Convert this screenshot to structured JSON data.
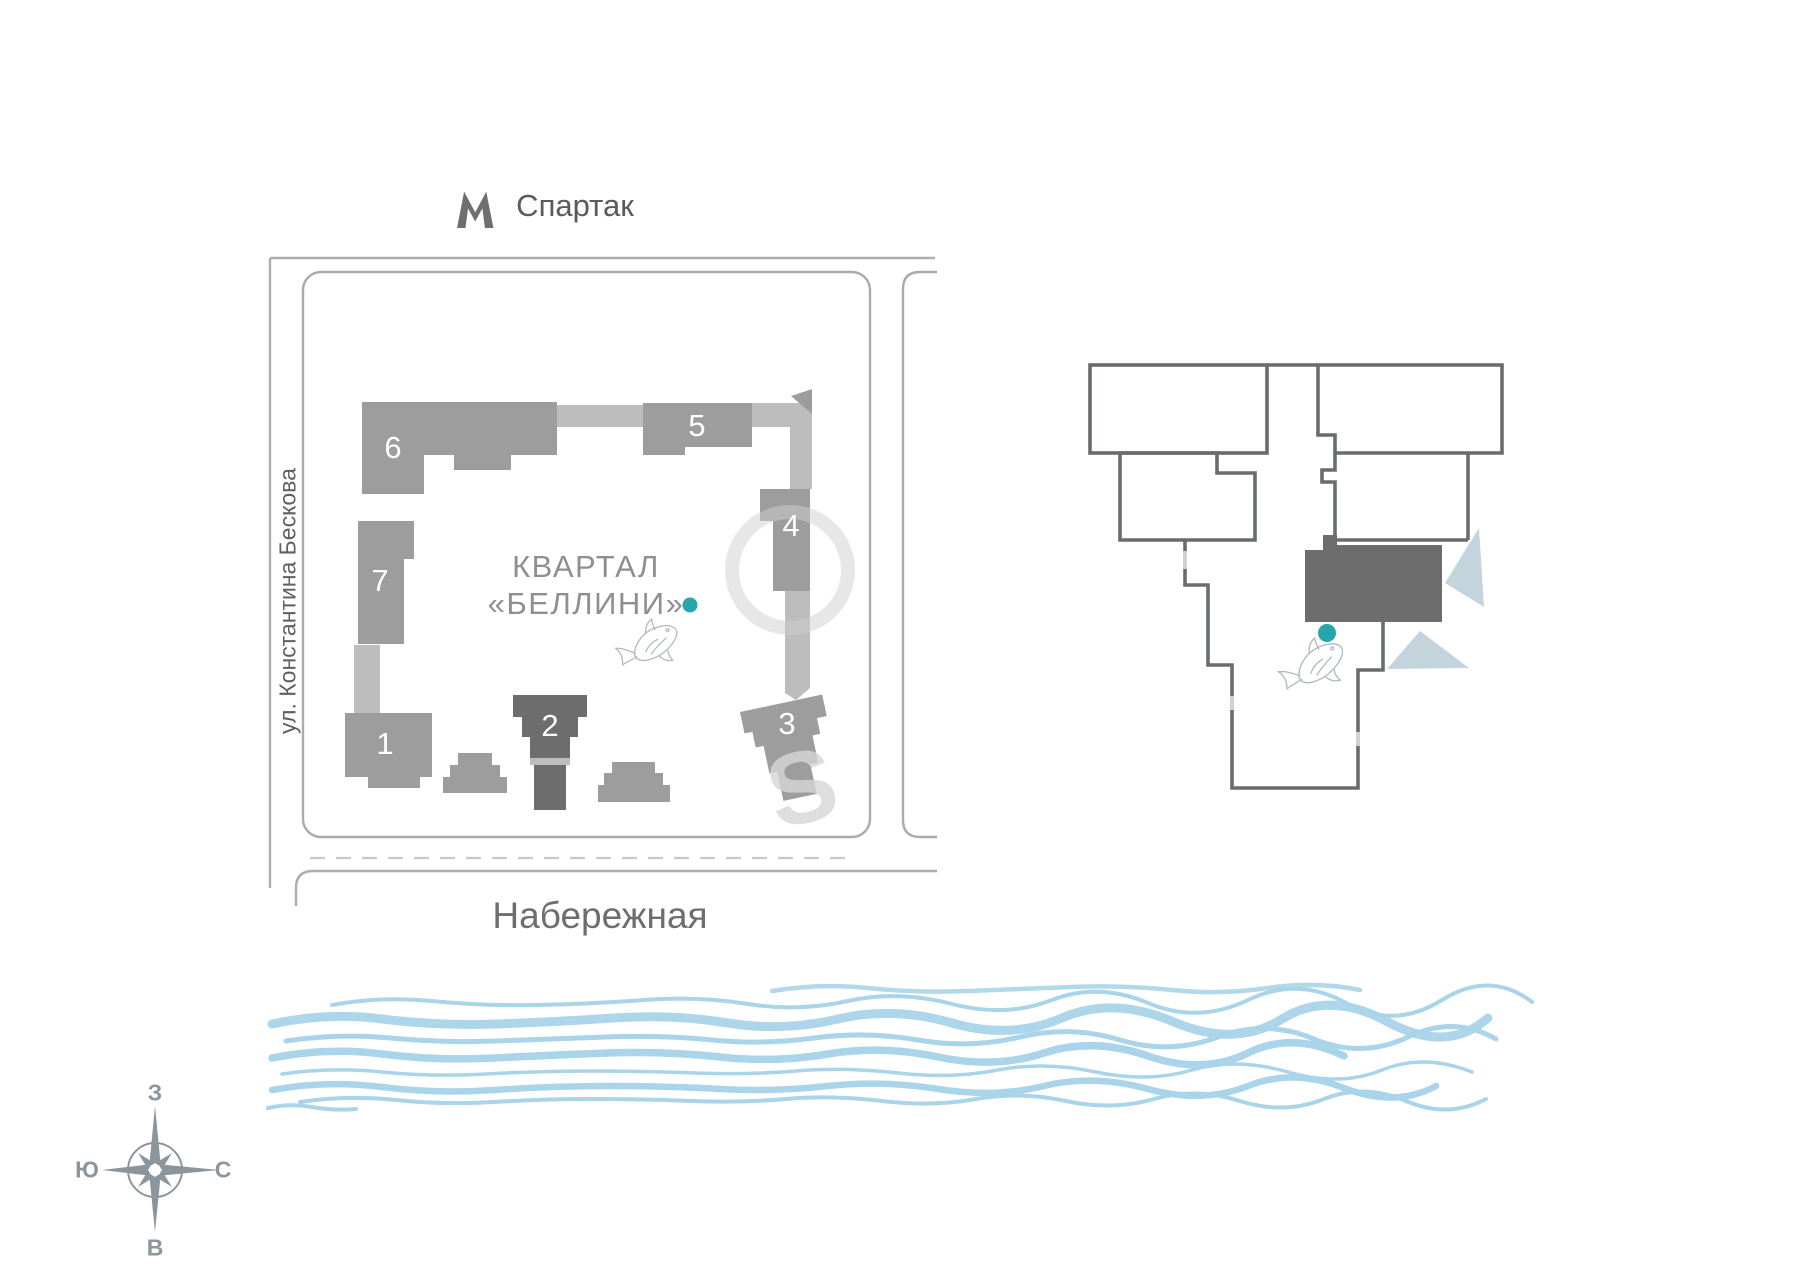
{
  "metro": {
    "icon": "metro-m-icon",
    "station": "Спартак"
  },
  "site_plan": {
    "quarter_title_line1": "КВАРТАЛ",
    "quarter_title_line2": "«БЕЛЛИНИ»",
    "street_left": "ул. Константина Бескова",
    "street_bottom": "Набережная",
    "buildings": [
      {
        "label": "1"
      },
      {
        "label": "2"
      },
      {
        "label": "3"
      },
      {
        "label": "4"
      },
      {
        "label": "5"
      },
      {
        "label": "6"
      },
      {
        "label": "7"
      }
    ],
    "highlighted_building": "2",
    "watermark_letter": "S",
    "marker_color": "#26a6ad"
  },
  "floor_plan": {
    "highlight_color": "#6d6d6d",
    "marker_color": "#26a6ad"
  },
  "compass": {
    "top": "З",
    "right": "С",
    "bottom": "В",
    "left": "Ю"
  },
  "colors": {
    "building": "#9d9d9d",
    "building_connector": "#bdbdbd",
    "building_highlight": "#6d6d6d",
    "road_line": "#aeaeae",
    "wall": "#696c6e",
    "wave": "#a9d4e9",
    "decor_triangle": "#b9ccd7",
    "compass": "#8b959b",
    "marker": "#26a6ad"
  }
}
